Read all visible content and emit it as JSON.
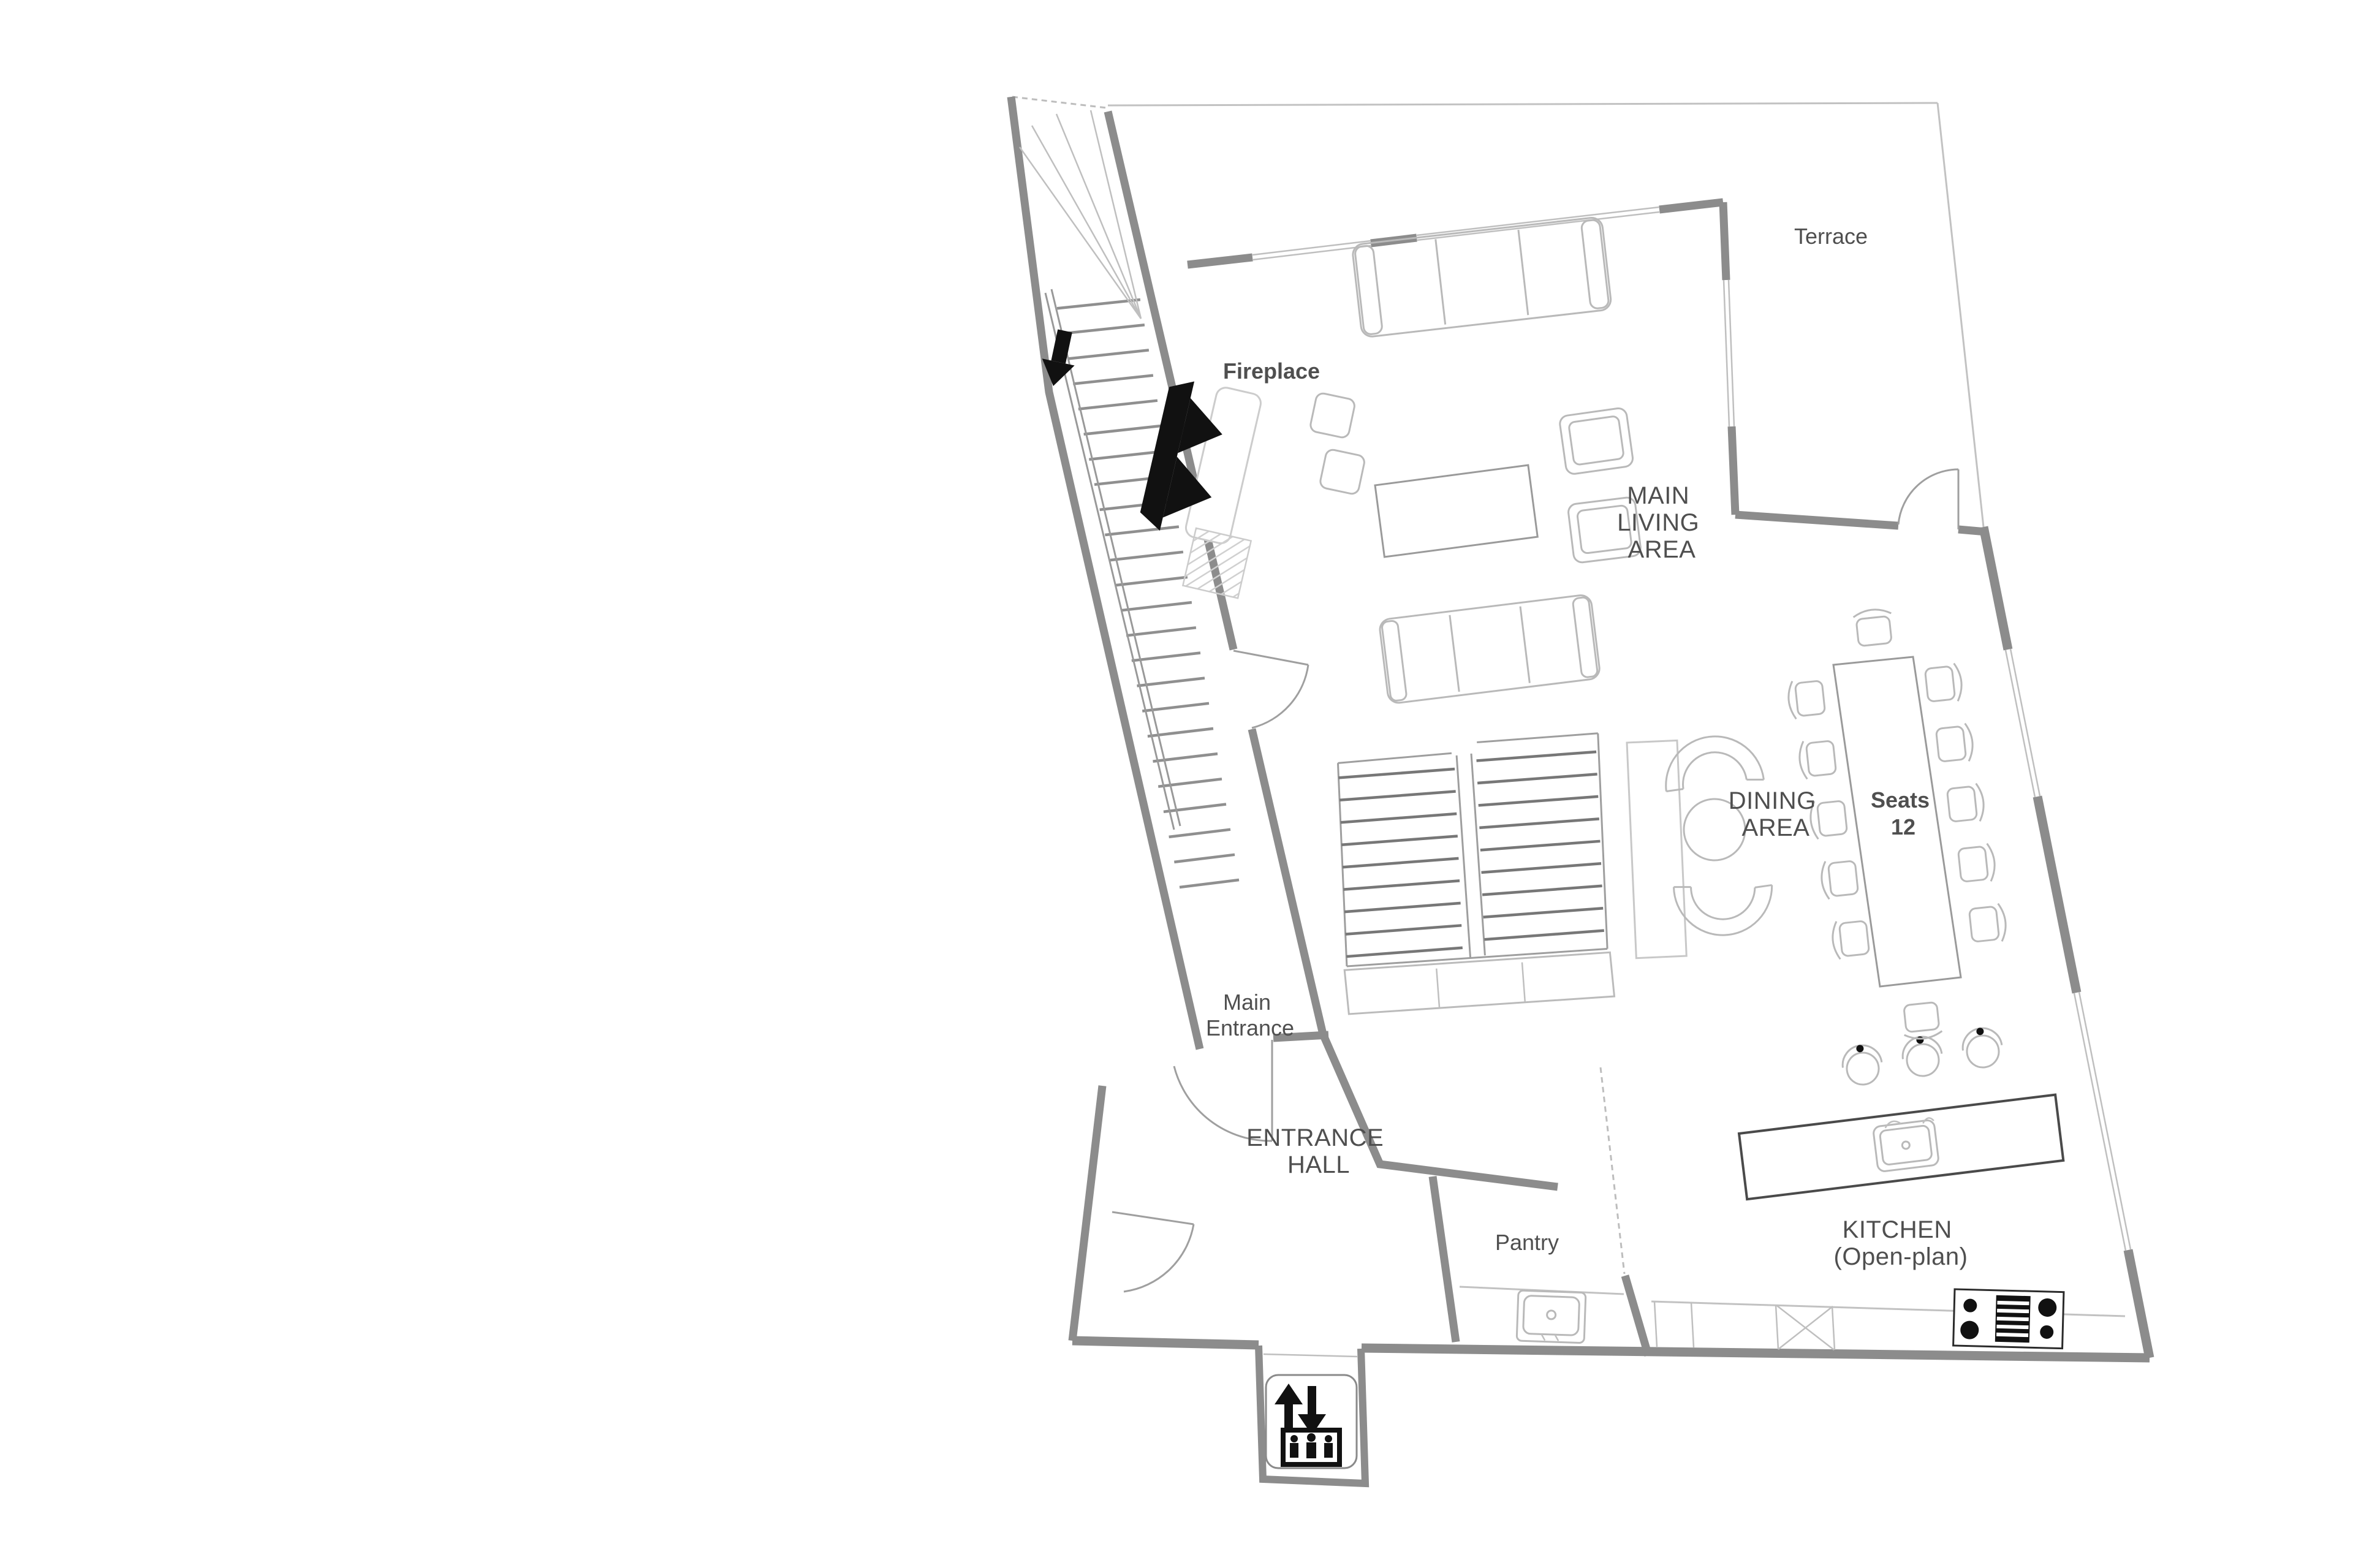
{
  "title": "First floor plan",
  "labels": {
    "terrace": "Terrace",
    "fireplace": "Fireplace",
    "main_living_area": {
      "lines": [
        "MAIN",
        "LIVING",
        "AREA"
      ]
    },
    "dining_area": {
      "lines": [
        "DINING",
        "AREA"
      ]
    },
    "seats": {
      "lines": [
        "Seats",
        "12"
      ],
      "count": "12"
    },
    "main_entrance": {
      "lines": [
        "Main",
        "Entrance"
      ]
    },
    "entrance_hall": {
      "lines": [
        "ENTRANCE",
        "HALL"
      ]
    },
    "pantry": "Pantry",
    "kitchen": {
      "lines": [
        "KITCHEN",
        "(Open-plan)"
      ]
    }
  },
  "icons": {
    "elevator": "elevator-up-down-people-icon",
    "stairs_direction": "down-arrow-icon",
    "fireplace": "fireplace-icon"
  },
  "colors": {
    "wall": "#8c8c8c",
    "furniture": "#b9b9b9",
    "text": "#4f4f4f",
    "black": "#111111",
    "background": "#ffffff"
  }
}
